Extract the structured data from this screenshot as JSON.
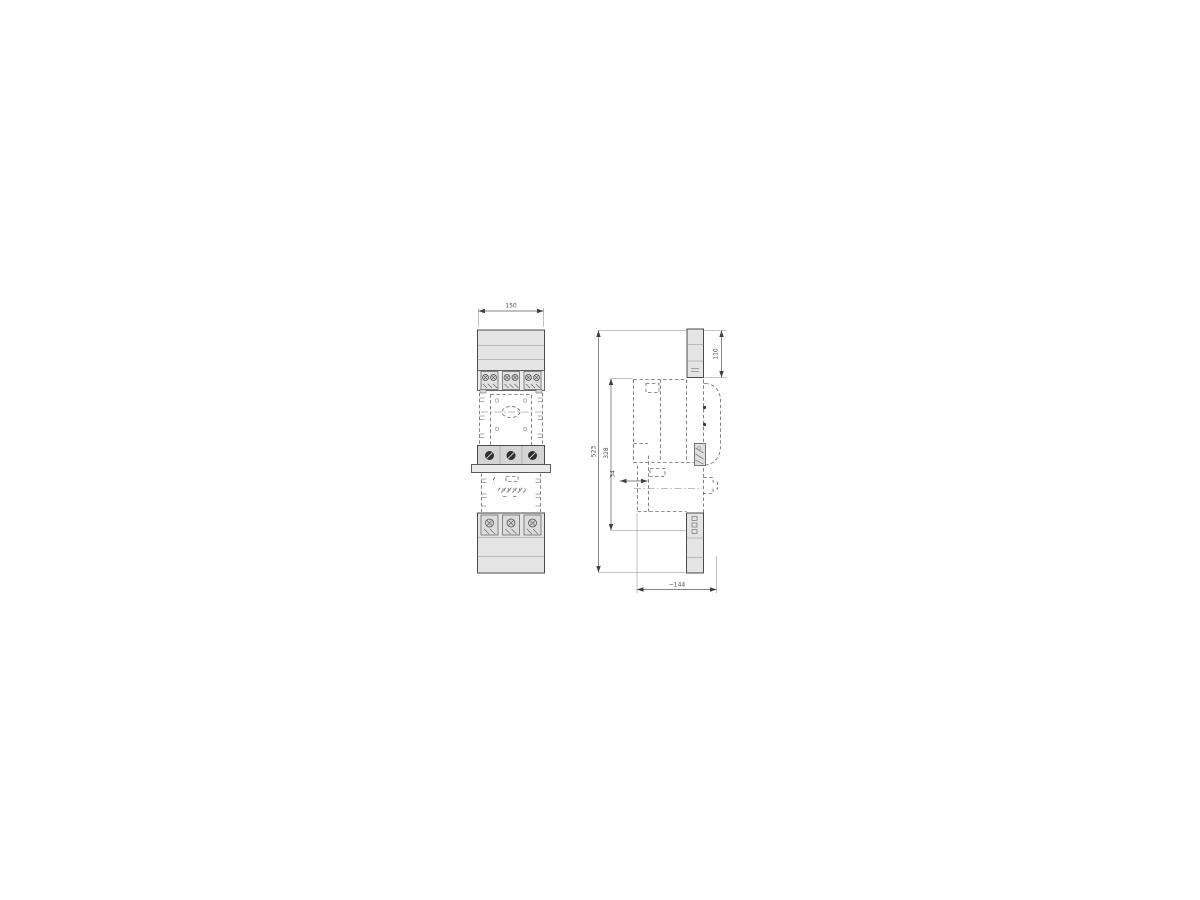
{
  "dims": {
    "front_width": "150",
    "side_top": "110",
    "overall_height": "523",
    "body_height": "328",
    "mount_offset": "34",
    "depth": "~144"
  },
  "colors": {
    "outline": "#4a4a4a",
    "dashed_line": "#6e6e6e",
    "fill_light": "#e4e4e4",
    "fill_mid": "#d4d4d4",
    "dim_line": "#5a5a5a",
    "dim_text": "#4d4d4d",
    "screw": "#2e2e2e",
    "background": "#ffffff"
  }
}
